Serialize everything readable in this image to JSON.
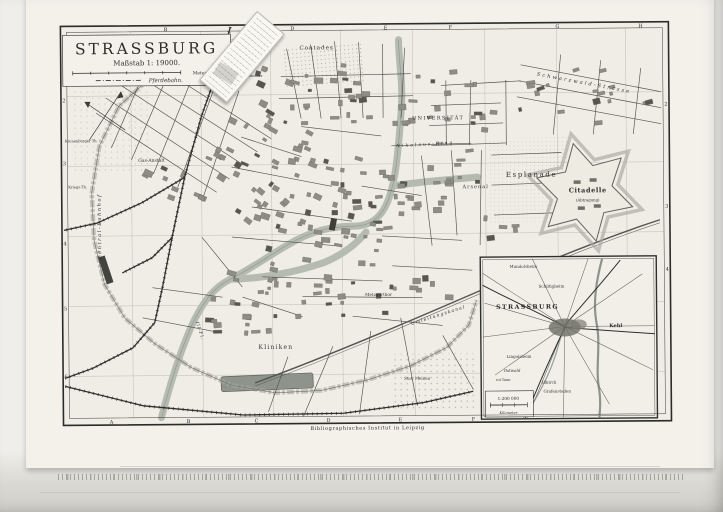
{
  "map": {
    "title_block": {
      "title": "STRASSBURG",
      "scale_text": "Maßstab 1: 19000.",
      "scale_bar_label": "Meter",
      "legend_pferdebahn": "Pferdebahn."
    },
    "credit": "Bibliographisches Institut in Leipzig",
    "grid": {
      "top": [
        "B",
        "D",
        "E",
        "F",
        "G",
        "H"
      ],
      "bottom": [
        "A",
        "B",
        "C",
        "D",
        "E",
        "F"
      ],
      "left": [
        "2",
        "3",
        "4",
        "5",
        "6"
      ],
      "right": [
        "2",
        "3",
        "4"
      ]
    },
    "labels": {
      "contades": "Contades",
      "schwarzwald_strasse": "Schwarzwald-Strasse",
      "universitaet": "UNIVERSITÄT",
      "nikolaus_ring": "Nikolaus-Ring",
      "esplanade": "Esplanade",
      "citadelle": "Citadelle",
      "citadelle_note": "(Abtragung)",
      "arsenal": "Arsenal",
      "kliniken": "Kliniken",
      "metzgerthor": "Metzgerthor",
      "umleitungskanal": "Umleitungskanal",
      "ill_fluss": "Ill-Fl.",
      "zentral_bahnhof": "Zentral-Bahnhof",
      "gas_anstalt": "Gas-Anstalt",
      "kronenburger_thor": "Kronenburger Th.",
      "kriegsthor": "Kriegs-Th.",
      "steinthor": "Steinthor",
      "stat_meinau": "Stat. Meinau"
    }
  },
  "inset": {
    "title": "STRASSBURG",
    "scale": "1:200 000",
    "scale_unit": "Kilometer",
    "towns": [
      {
        "name": "Mundolsheim"
      },
      {
        "name": "Schiltigheim"
      },
      {
        "name": "Kehl"
      },
      {
        "name": "Lingolsheim"
      },
      {
        "name": "Ostwald"
      },
      {
        "name": "Illkirch"
      },
      {
        "name": "Grafenstaden"
      },
      {
        "name": "v.d.Tann"
      }
    ]
  },
  "colors": {
    "paper": "#f3f1ea",
    "ink": "#2e2e2a",
    "water": "#b6bbb1",
    "blocks": "#8d8d86",
    "fortwall": "#a7a79f"
  }
}
